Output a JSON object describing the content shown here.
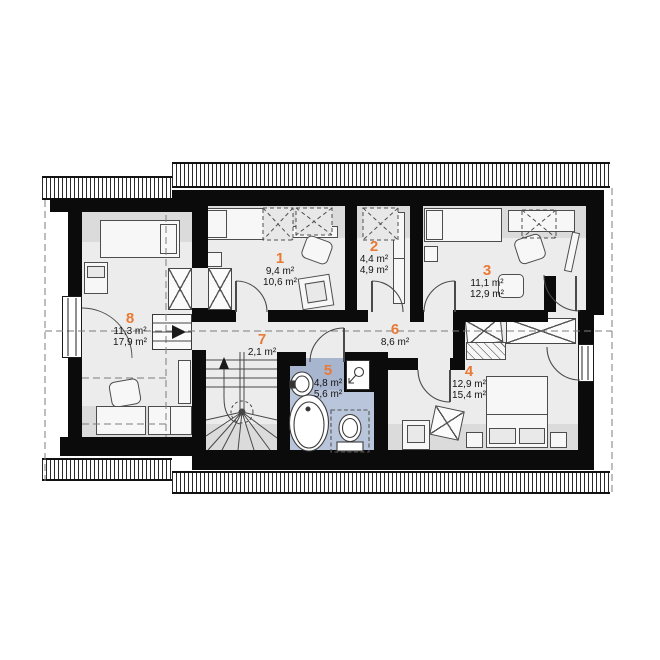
{
  "floorplan": {
    "title": "attic floor plan",
    "accent_color": "#e87a35",
    "bathroom_fill": "#b9c5da",
    "bathroom_fill_dark": "#a7b5cf",
    "wall_color": "#0b0b0b",
    "rooms": [
      {
        "number": "1",
        "area_line1": "9,4 m²",
        "area_line2": "10,6 m²"
      },
      {
        "number": "2",
        "area_line1": "4,4 m²",
        "area_line2": "4,9 m²"
      },
      {
        "number": "3",
        "area_line1": "11,1 m²",
        "area_line2": "12,9 m²"
      },
      {
        "number": "4",
        "area_line1": "12,9 m²",
        "area_line2": "15,4 m²"
      },
      {
        "number": "5",
        "area_line1": "4,8 m²",
        "area_line2": "5,6 m²"
      },
      {
        "number": "6",
        "area_line1": "8,6 m²"
      },
      {
        "number": "7",
        "area_line1": "2,1 m²"
      },
      {
        "number": "8",
        "area_line1": "11,3 m²",
        "area_line2": "17,9 m²"
      }
    ]
  }
}
